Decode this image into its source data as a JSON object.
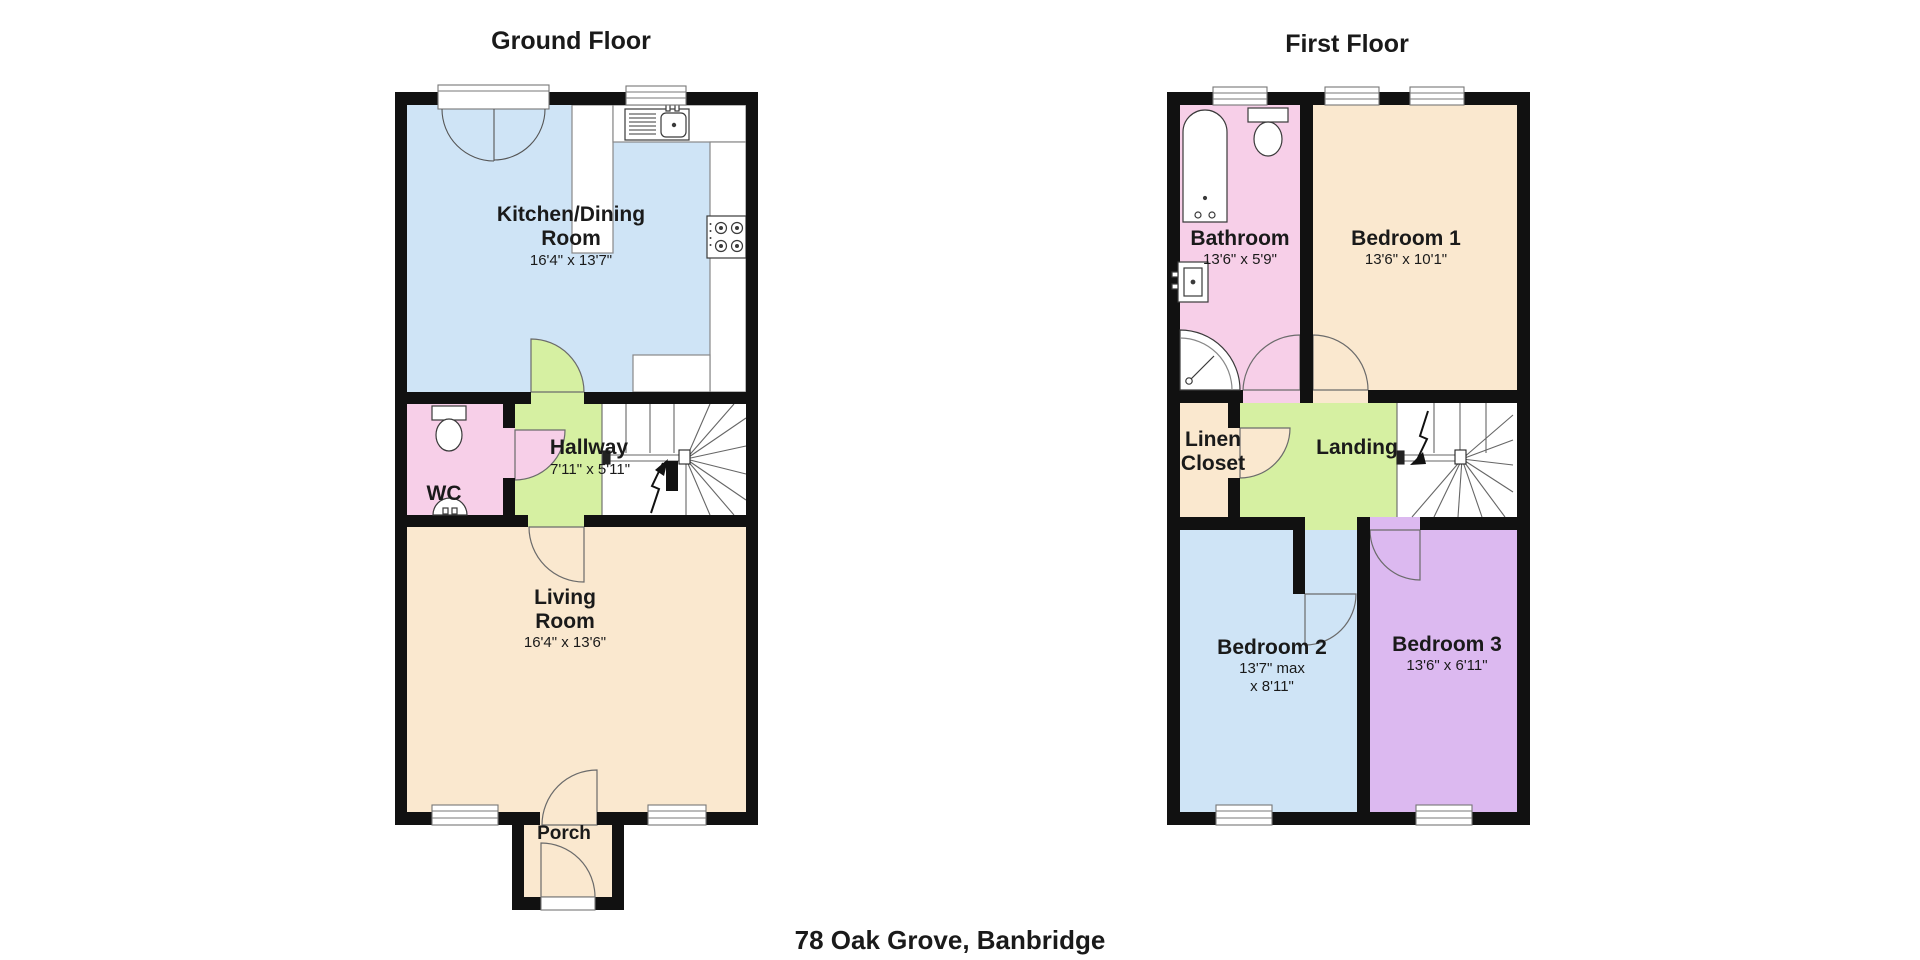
{
  "address": "78 Oak Grove, Banbridge",
  "palette": {
    "wall": "#111111",
    "room_blue": "#cfe4f6",
    "room_cream": "#fae8cf",
    "room_pink": "#f7cfe8",
    "room_green": "#d6f0a2",
    "room_purple": "#dcb9f0",
    "fixture_stroke": "#3a3a3a",
    "counter_stroke": "#888888",
    "door_stroke": "#6b6b6b"
  },
  "floors": [
    {
      "name": "Ground Floor",
      "rooms": [
        {
          "label": "Kitchen/Dining\nRoom",
          "dims": "16'4\" x 13'7\""
        },
        {
          "label": "WC",
          "dims": ""
        },
        {
          "label": "Hallway",
          "dims": "7'11\" x 5'11\""
        },
        {
          "label": "Living\nRoom",
          "dims": "16'4\" x 13'6\""
        },
        {
          "label": "Porch",
          "dims": ""
        }
      ]
    },
    {
      "name": "First Floor",
      "rooms": [
        {
          "label": "Bathroom",
          "dims": "13'6\" x 5'9\""
        },
        {
          "label": "Bedroom 1",
          "dims": "13'6\" x 10'1\""
        },
        {
          "label": "Linen\nCloset",
          "dims": ""
        },
        {
          "label": "Landing",
          "dims": ""
        },
        {
          "label": "Bedroom 2",
          "dims": "13'7\" max\nx 8'11\""
        },
        {
          "label": "Bedroom 3",
          "dims": "13'6\" x 6'11\""
        }
      ]
    }
  ]
}
